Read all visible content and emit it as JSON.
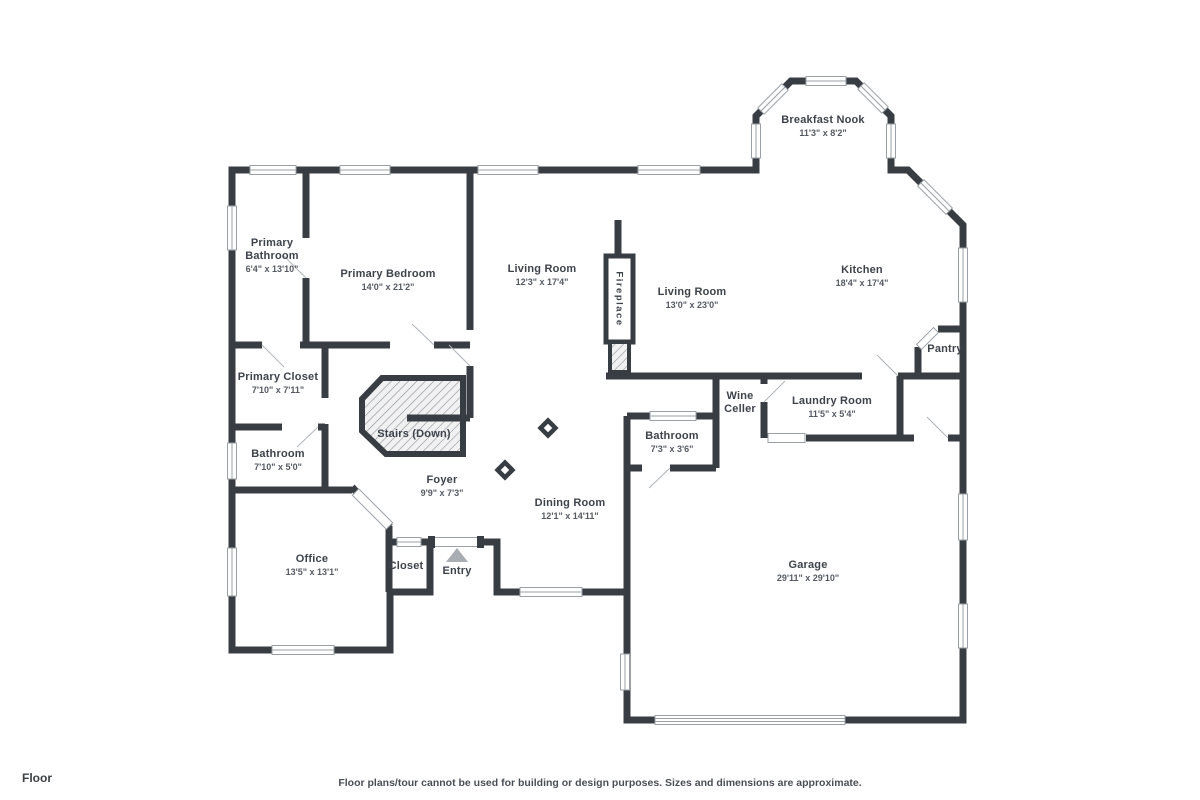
{
  "page": {
    "footer_label": "Floor",
    "disclaimer": "Floor plans/tour cannot be used for building or design purposes. Sizes and dimensions are approximate."
  },
  "colors": {
    "wall": "#383d44",
    "floor_fill": "#f6f6f7",
    "window_outline": "#9aa0a6",
    "label_text": "#3e434b",
    "dims_text": "#555a62",
    "entry_arrow": "#a7adb3"
  },
  "floor_plan": {
    "rooms": {
      "breakfast_nook": {
        "name": "Breakfast Nook",
        "dims": "11'3\" x 8'2\""
      },
      "primary_bathroom": {
        "name": "Primary Bathroom",
        "dims": "6'4\" x 13'10\""
      },
      "primary_bedroom": {
        "name": "Primary Bedroom",
        "dims": "14'0\" x 21'2\""
      },
      "living_room_west": {
        "name": "Living Room",
        "dims": "12'3\" x 17'4\""
      },
      "living_room_east": {
        "name": "Living Room",
        "dims": "13'0\" x 23'0\""
      },
      "kitchen": {
        "name": "Kitchen",
        "dims": "18'4\" x 17'4\""
      },
      "pantry": {
        "name": "Pantry",
        "dims": ""
      },
      "primary_closet": {
        "name": "Primary Closet",
        "dims": "7'10\" x 7'11\""
      },
      "bathroom_main": {
        "name": "Bathroom",
        "dims": "7'10\" x 5'0\""
      },
      "stairs": {
        "name": "Stairs (Down)",
        "dims": ""
      },
      "wine_celler": {
        "name": "Wine Celler",
        "dims": ""
      },
      "laundry_room": {
        "name": "Laundry Room",
        "dims": "11'5\" x 5'4\""
      },
      "bathroom_garage": {
        "name": "Bathroom",
        "dims": "7'3\" x 3'6\""
      },
      "foyer": {
        "name": "Foyer",
        "dims": "9'9\" x 7'3\""
      },
      "dining_room": {
        "name": "Dining Room",
        "dims": "12'1\" x 14'11\""
      },
      "office": {
        "name": "Office",
        "dims": "13'5\" x 13'1\""
      },
      "closet": {
        "name": "Closet",
        "dims": ""
      },
      "entry": {
        "name": "Entry",
        "dims": ""
      },
      "garage": {
        "name": "Garage",
        "dims": "29'11\" x 29'10\""
      },
      "fireplace": {
        "name": "Fireplace"
      }
    },
    "features": [
      "entry-direction-triangle-icon",
      "stairs-hatch",
      "fireplace-hatch",
      "column-markers",
      "garage-door",
      "windows"
    ]
  }
}
